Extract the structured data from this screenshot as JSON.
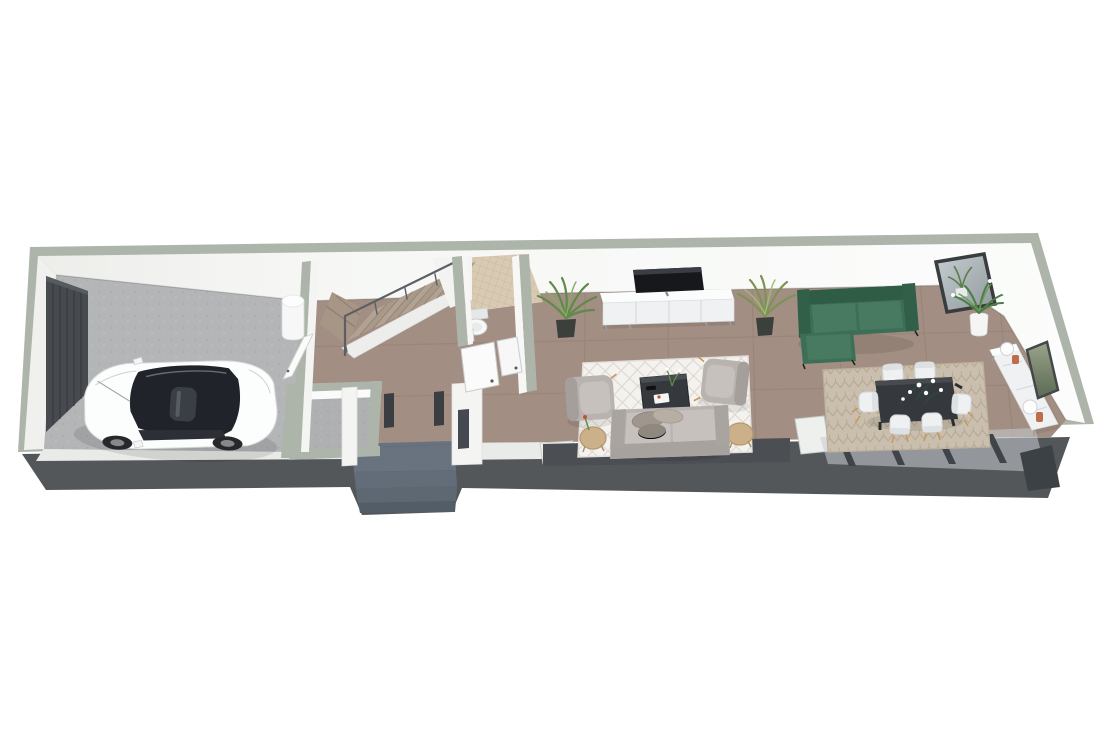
{
  "scene": {
    "kind": "3d-floor-plan-render",
    "view": "isometric-top",
    "background": "#ffffff"
  },
  "rooms": [
    {
      "id": "garage",
      "objects": [
        "garage-door",
        "white-hatchback-car",
        "water-heater",
        "door-to-hall"
      ]
    },
    {
      "id": "hallway",
      "objects": [
        "front-door",
        "side-window-slot",
        "entry-steps"
      ]
    },
    {
      "id": "staircase",
      "objects": [
        "winder-steps",
        "straight-flight",
        "metal-handrail",
        "white-stringer"
      ]
    },
    {
      "id": "wc",
      "objects": [
        "beige-mosaic-floor",
        "toilet",
        "hand-basin",
        "open-door",
        "open-door"
      ]
    },
    {
      "id": "storage-room",
      "objects": [
        "concrete-floor"
      ]
    },
    {
      "id": "living-room",
      "objects": [
        "wall-tv",
        "tv-console",
        "palm-plant",
        "palm-plant",
        "diamond-rug",
        "armchair",
        "armchair",
        "round-side-table",
        "round-side-table",
        "coffee-table",
        "gray-sofa",
        "window-wall"
      ]
    },
    {
      "id": "dining-area",
      "objects": [
        "green-sectional-sofa",
        "leaning-mirror",
        "white-potted-plant",
        "patterned-rug",
        "dark-dining-table",
        "dining-chair",
        "dining-chair",
        "dining-chair",
        "dining-chair",
        "dining-chair",
        "dining-chair",
        "white-sideboard",
        "sphere-lamp",
        "sphere-lamp",
        "terracotta-vase",
        "terracotta-vase",
        "wall-artwork",
        "glass-sliding-doors"
      ]
    }
  ],
  "palette": {
    "background": "#ffffff",
    "wall_cap": "#adb5aa",
    "wall_face": "#f4f5f3",
    "wall_face_shade": "#e6e8e5",
    "exterior_band": "#54575a",
    "floor_main": "#a28e82",
    "floor_garage": "#b3b5b7",
    "floor_porch": "#68737f",
    "porch_step": "#5d6873",
    "wc_tile": "#d9cab3",
    "stair_tread": "#b2a294",
    "stair_shadow": "#8e7e71",
    "handrail": "#5c6064",
    "garage_door": "#474b4f",
    "car_body": "#fcfdfd",
    "car_glass": "#20242a",
    "sofa_gray": "#b9b3af",
    "cushion_gray": "#c6c1bd",
    "sofa_green": "#3c6f55",
    "sofa_green_dark": "#2f5c45",
    "rug_light": "#f4f2ee",
    "rug_beige": "#cabfae",
    "table_dark": "#35383c",
    "chair_white": "#eef0f1",
    "wood": "#c6975a",
    "plant_green": "#5f8a4a",
    "plant_light": "#86ab63",
    "pot_dark": "#3c403d",
    "console_white": "#eff1f2",
    "tv_black": "#16181b",
    "mirror_frame": "#3a3d40",
    "terracotta": "#bf6c4b",
    "glass_band": "#4b4f54",
    "door_jamb": "#3a3e42"
  }
}
